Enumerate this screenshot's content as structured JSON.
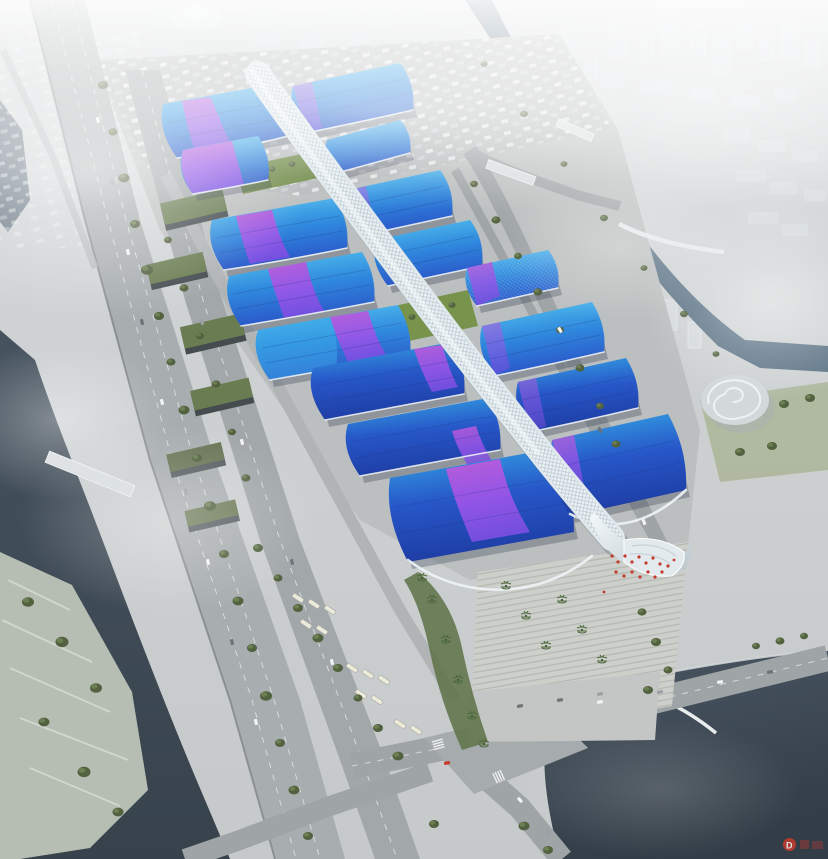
{
  "scene": {
    "title": "Aerial rendering of a large riverside exhibition & convention center",
    "type": "architectural aerial rendering",
    "time_of_day": "hazy daylight",
    "halls_left_wing": 7,
    "halls_right_wing": 7,
    "central_corridor": "white lattice spine crossing all halls diagonally",
    "surroundings": [
      "elevated expressway",
      "canals and lake",
      "waterfront park",
      "parking lots",
      "foggy city skyline"
    ]
  },
  "features": {
    "complex": "exhibition-complex",
    "spine": "central lattice concourse",
    "halls": "wave-roofed exhibition halls",
    "parking": "truck marshalling parking lot",
    "plaza": "south entrance stepped plaza",
    "lake": "south-east lake",
    "river_left": "west canal",
    "river_right": "north-east canal",
    "park": "terraced waterfront park",
    "city": "distant city in fog",
    "conch": "spiral visitor pavilion",
    "crowd": "visitors with red flags at entrance"
  },
  "palette": {
    "ground": "#c6c9c9",
    "ground_dark": "#b7babb",
    "plaza": "#cdcfca",
    "road": "#9fa4a6",
    "highway": "#a8adaf",
    "water": "#46535f",
    "water_deep": "#37424c",
    "river": "#5d7486",
    "tree": "#52613f",
    "tree_light": "#6b7f52",
    "lawn": "#6f8a47",
    "roof_top": "#55c8f2",
    "roof_mid": "#2f86dc",
    "roof_deep": "#2a55c8",
    "roof_navy": "#1e3da4",
    "ribbon_pink": "#c45ad8",
    "ribbon_violet": "#7b4fe2",
    "spine": "#eaf1f4",
    "spine_shade": "#b9c6cd",
    "city": "#d6dbdf",
    "fog": "#ffffff",
    "warehouse": "#6a7d52",
    "red_accent": "#c53a2c"
  },
  "watermark": {
    "letter": "D",
    "color": "#c0392b"
  }
}
